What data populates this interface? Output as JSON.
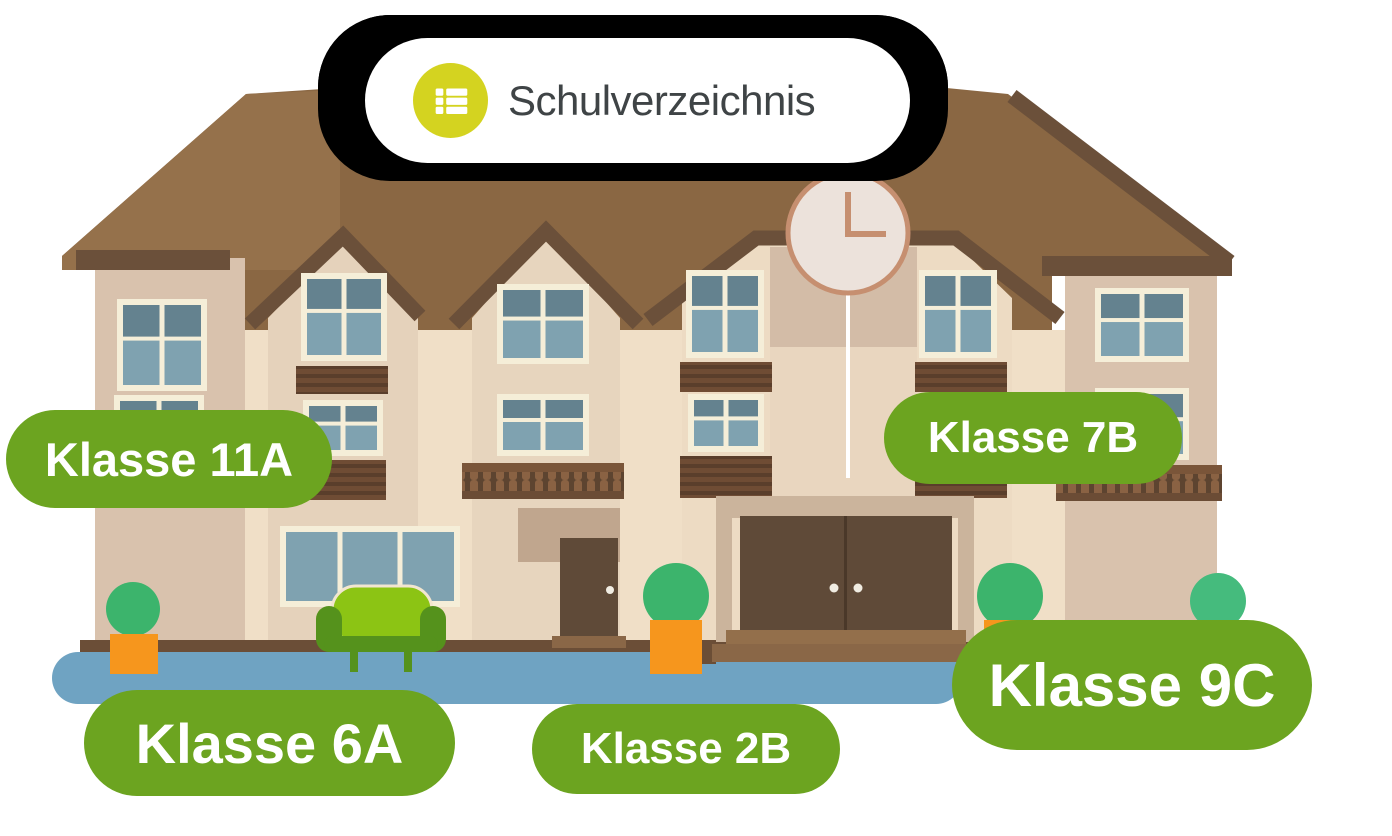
{
  "header_badge": {
    "label": "Schulverzeichnis",
    "icon": "list-icon"
  },
  "class_labels": [
    {
      "label": "Klasse 11A"
    },
    {
      "label": "Klasse 7B"
    },
    {
      "label": "Klasse 6A"
    },
    {
      "label": "Klasse 2B"
    },
    {
      "label": "Klasse 9C"
    }
  ],
  "illustration": {
    "subject": "school building with clock gable, balconies, bushes in pots, green sofa",
    "clock_time": "3:00"
  },
  "colors": {
    "label_green": "#6ca420",
    "badge_icon_yellow": "#d4d320",
    "badge_text": "#3f4446",
    "roof_brown": "#8a6743",
    "roof_trim": "#6b503a",
    "wall_cream": "#f0dfc7",
    "wall_shaded": "#d9c2ad",
    "window_pane": "#7fa2b0",
    "ground_blue": "#6fa3c2",
    "bush_green": "#3cb46c",
    "pot_orange": "#f6961d",
    "clock_copper": "#c68f70"
  }
}
